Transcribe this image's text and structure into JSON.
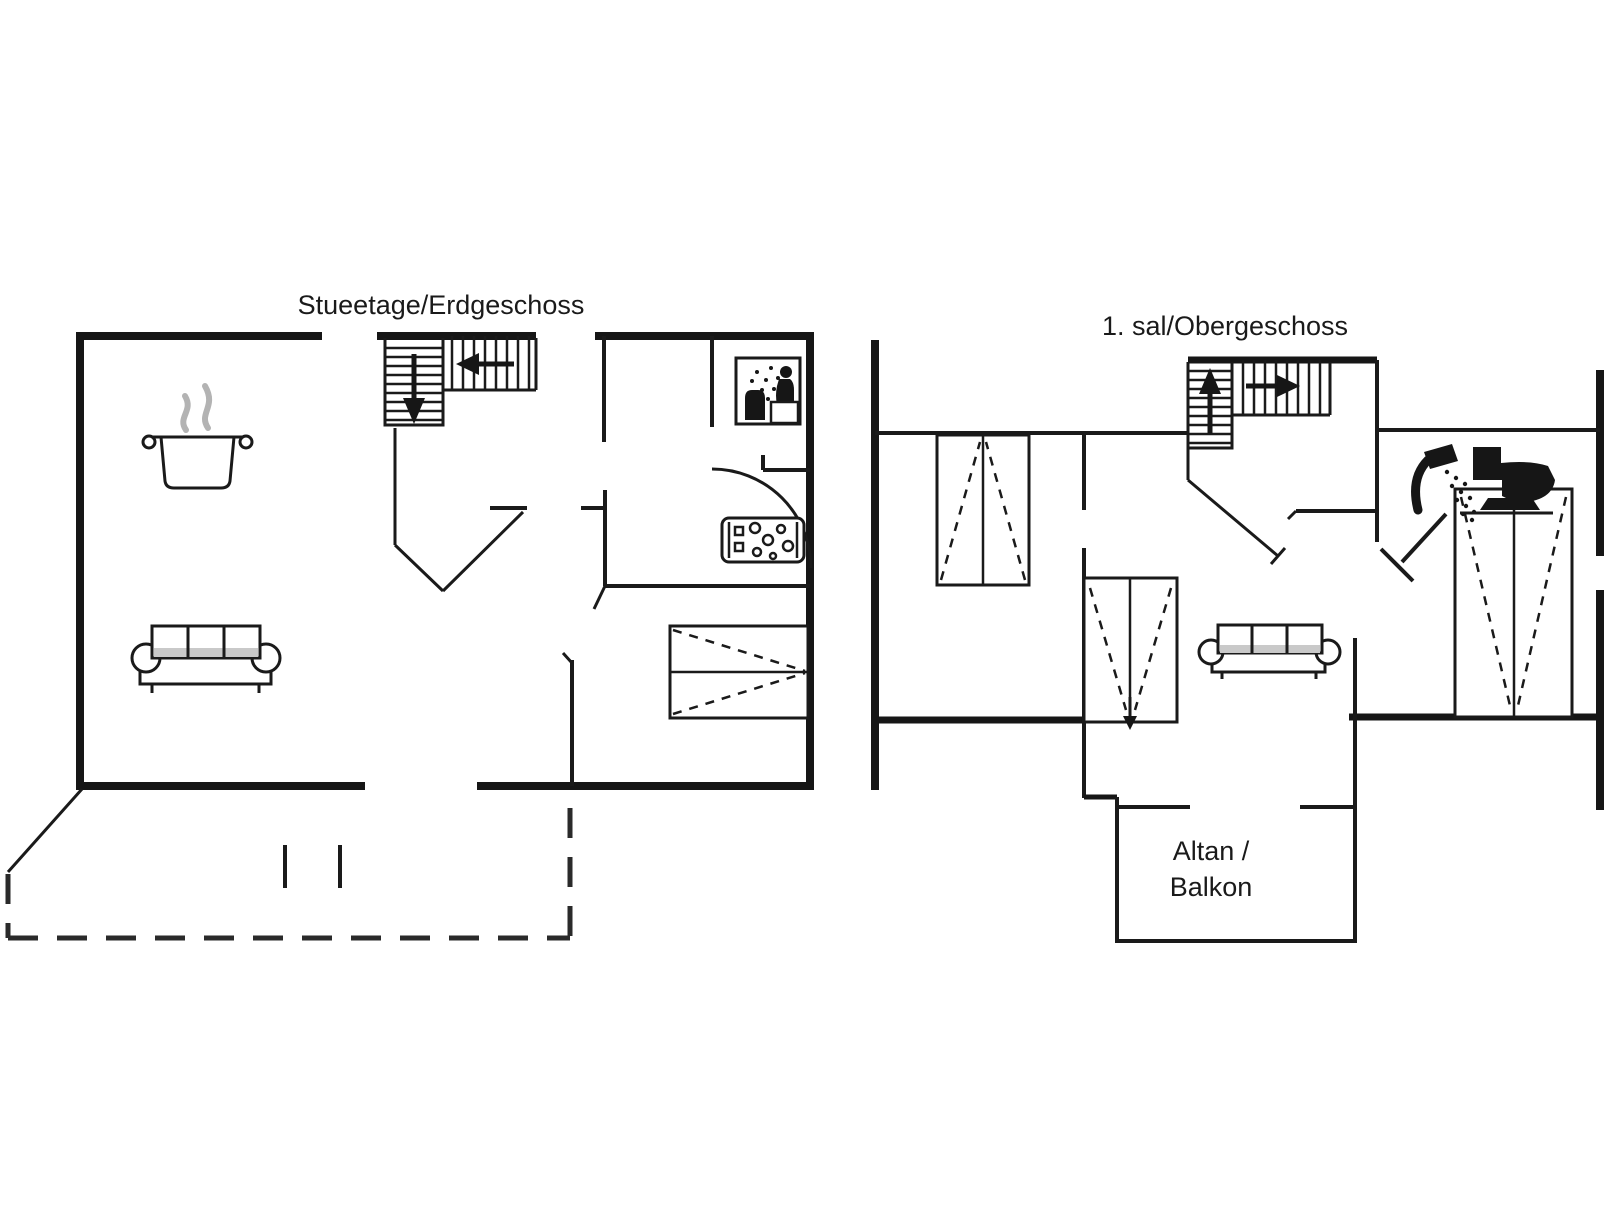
{
  "page": {
    "background_color": "#ffffff",
    "line_color": "#161616",
    "steam_color": "#b3b3b3",
    "type": "floor-plan"
  },
  "ground_floor": {
    "title": "Stueetage/Erdgeschoss",
    "icons": [
      "stairs-down-icon",
      "cooking-pot-icon",
      "steam-icon",
      "sofa-icon",
      "wardrobe-icon",
      "shower-cabin-icon",
      "whirlpool-icon",
      "door-arc-icon",
      "terrace-dashed-outline",
      "sliding-door-marks"
    ]
  },
  "first_floor": {
    "title": "1. sal/Obergeschoss",
    "balcony_label_line1": "Altan /",
    "balcony_label_line2": "Balkon",
    "icons": [
      "stairs-up-icon",
      "wardrobe-a-icon",
      "wardrobe-v-icon",
      "wardrobe-v2-icon",
      "sofa-icon",
      "shower-head-icon",
      "toilet-icon",
      "door-swing-icon",
      "balcony-outline"
    ]
  }
}
